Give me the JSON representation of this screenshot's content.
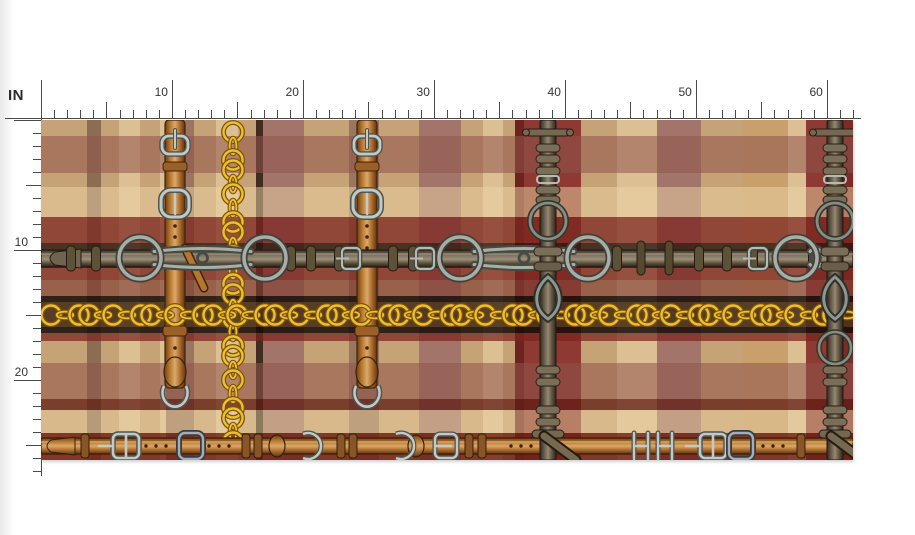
{
  "page": {
    "background": "#ffffff"
  },
  "rulers": {
    "unit_label": "IN",
    "tick_color": "#4a4a4a",
    "label_color": "#333333",
    "horizontal": {
      "labels": [
        "10",
        "20",
        "30",
        "40",
        "50",
        "60"
      ],
      "origin_x": 41,
      "baseline_y": 118,
      "px_per_inch": 13.097,
      "total_inches": 62
    },
    "vertical": {
      "labels": [
        "10",
        "20"
      ],
      "origin_y": 120,
      "line_x": 41,
      "px_per_inch": 13.0,
      "total_inches": 27
    }
  },
  "fabric": {
    "x": 41,
    "y": 120,
    "width": 812,
    "height": 340,
    "palette": {
      "tan": "#c6a376",
      "tan2": "#c9a06c",
      "cream": "#dcc094",
      "mauve": "#a3756a",
      "taupe": "#8d6c54",
      "strapbase": "#99765f",
      "chocolate": "#402c20",
      "maroon": "#8e3a33",
      "darkred": "#7c2b26",
      "deep": "#6d2420"
    },
    "plaid_columns": [
      [
        0,
        46,
        "tan"
      ],
      [
        46,
        14,
        "taupe"
      ],
      [
        60,
        18,
        "tan"
      ],
      [
        78,
        21,
        "cream"
      ],
      [
        99,
        20,
        "tan"
      ],
      [
        119,
        6,
        "cream"
      ],
      [
        125,
        28,
        "strapbase"
      ],
      [
        153,
        22,
        "tan"
      ],
      [
        175,
        22,
        "cream"
      ],
      [
        197,
        18,
        "tan"
      ],
      [
        215,
        7,
        "chocolate"
      ],
      [
        222,
        41,
        "mauve"
      ],
      [
        263,
        45,
        "tan"
      ],
      [
        308,
        30,
        "strapbase"
      ],
      [
        338,
        40,
        "tan"
      ],
      [
        378,
        42,
        "mauve"
      ],
      [
        420,
        22,
        "tan"
      ],
      [
        442,
        20,
        "cream"
      ],
      [
        462,
        12,
        "tan"
      ],
      [
        474,
        9,
        "deep"
      ],
      [
        483,
        25,
        "maroon"
      ],
      [
        508,
        7,
        "chocolate"
      ],
      [
        515,
        25,
        "maroon"
      ],
      [
        540,
        36,
        "tan"
      ],
      [
        576,
        40,
        "cream"
      ],
      [
        616,
        44,
        "mauve"
      ],
      [
        660,
        42,
        "tan"
      ],
      [
        702,
        45,
        "tan2"
      ],
      [
        747,
        18,
        "cream"
      ],
      [
        765,
        24,
        "maroon"
      ],
      [
        789,
        23,
        "darkred"
      ]
    ],
    "plaid_rows": [
      [
        0,
        16,
        "rgba(0,0,0,0)"
      ],
      [
        16,
        37,
        "rgba(143,84,74,0.55)"
      ],
      [
        53,
        14,
        "rgba(0,0,0,0)"
      ],
      [
        67,
        30,
        "rgba(236,212,166,0.5)"
      ],
      [
        97,
        26,
        "rgba(125,36,30,0.72)"
      ],
      [
        123,
        6,
        "rgba(40,22,14,0.8)"
      ],
      [
        129,
        19,
        "rgba(56,36,24,0.85)"
      ],
      [
        148,
        12,
        "rgba(125,36,30,0.72)"
      ],
      [
        160,
        16,
        "rgba(130,62,50,0.65)"
      ],
      [
        176,
        6,
        "rgba(22,12,8,0.85)"
      ],
      [
        182,
        25,
        "rgba(74,50,28,0.9)"
      ],
      [
        207,
        6,
        "rgba(22,12,8,0.85)"
      ],
      [
        213,
        8,
        "rgba(125,36,30,0.72)"
      ],
      [
        221,
        22,
        "rgba(0,0,0,0)"
      ],
      [
        243,
        36,
        "rgba(143,84,74,0.55)"
      ],
      [
        279,
        11,
        "rgba(97,28,22,0.75)"
      ],
      [
        290,
        23,
        "rgba(236,212,166,0.45)"
      ],
      [
        313,
        27,
        "rgba(114,28,22,0.8)"
      ]
    ],
    "hardware": {
      "vertical_strap_xs": [
        134,
        326
      ],
      "vertical_chain_x": 192,
      "bit_strap_xs": [
        507,
        794
      ],
      "belt_center_y": 138,
      "chain_center_y": 195,
      "bottom_belt_center_y": 326,
      "belt_ring_xs": [
        99,
        224,
        419,
        547,
        755
      ],
      "gold": "#edbf35",
      "gold_dark": "#7e5606",
      "silver": "#c3c9c5",
      "silver_dark": "#4e5450",
      "gunmetal": "#383c42",
      "gunmetal_light": "#a7adb5"
    }
  }
}
